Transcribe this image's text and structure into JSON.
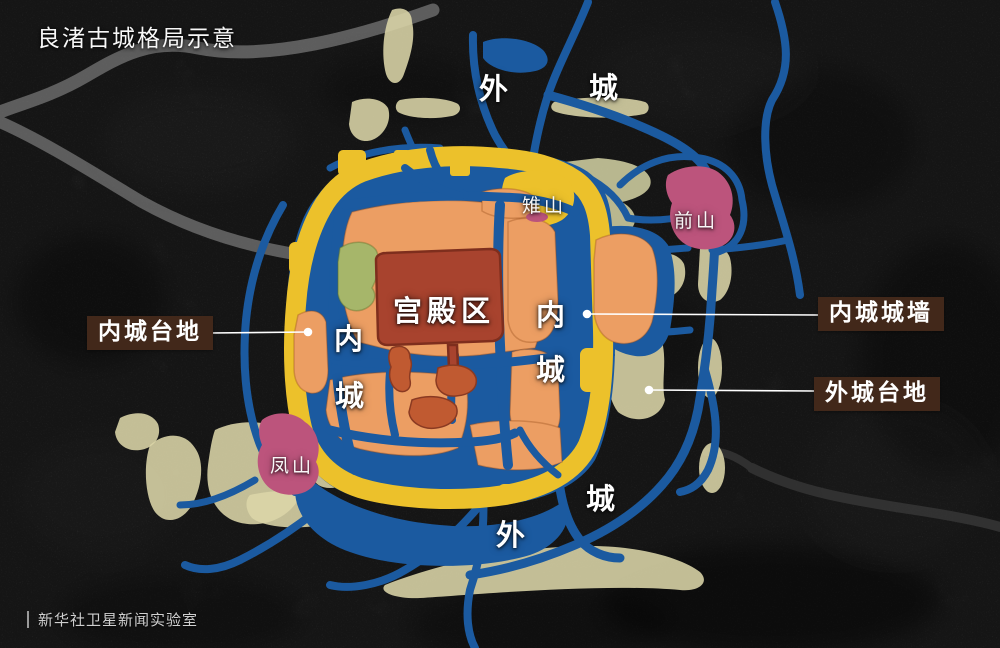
{
  "title": "良渚古城格局示意",
  "attribution": "新华社卫星新闻实验室",
  "labels": {
    "outer_top": [
      "外",
      "城"
    ],
    "outer_bottom": [
      "外",
      "城"
    ],
    "inner_left": [
      "内",
      "城"
    ],
    "inner_right": [
      "内",
      "城"
    ],
    "palace": "宫殿区",
    "zhishan": "雉山",
    "qianshan": "前山",
    "fengshan": "凤山"
  },
  "callouts": {
    "inner_platform": "内城台地",
    "inner_wall": "内城城墙",
    "outer_platform": "外城台地"
  },
  "legend_colors": {
    "water": "#1b5aa0",
    "city_wall": "#ecc12b",
    "inner_platform": "#ec9e63",
    "palace": "#a8432e",
    "palace_secondary": "#c05a31",
    "green_area": "#a6b66a",
    "hills": "#bc547c",
    "outer_platform": "#dcd6a9",
    "callout_bg": "#42281a"
  }
}
